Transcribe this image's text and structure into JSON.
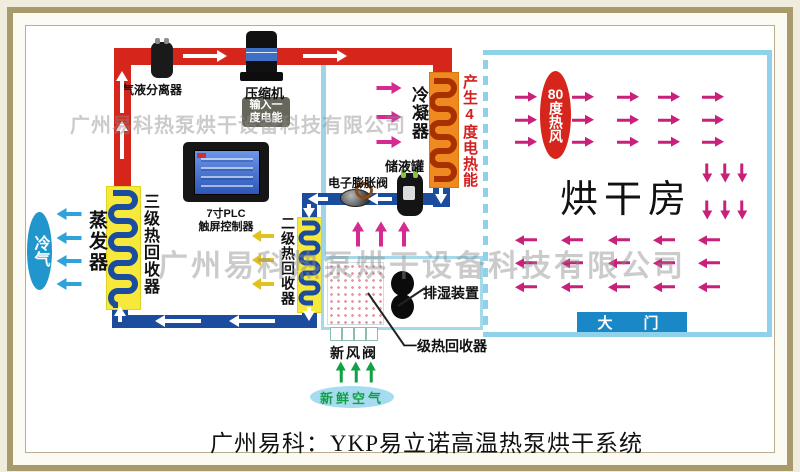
{
  "page": {
    "title_caption": "广州易科：YKP易立诺高温热泵烘干系统"
  },
  "watermarks": {
    "top": "广州易科热泵烘干设备科技有限公司",
    "middle": "广州易科热泵烘干设备科技有限公司"
  },
  "labels": {
    "gas_liquid_separator": "气液分离器",
    "compressor": "压缩机",
    "power_badge_line1": "输入一",
    "power_badge_line2": "度电能",
    "plc_line1": "7寸PLC",
    "plc_line2": "触屏控制器",
    "condenser": "冷凝器",
    "heat_gain_note": "产生4度电热能",
    "liquid_tank": "储液罐",
    "expansion_valve": "电子膨胀阀",
    "evaporator": "蒸发器",
    "stage3_recovery": "三级热回收器",
    "stage2_recovery": "二级热回收器",
    "stage1_recovery": "一级热回收器",
    "dehumidifier": "排湿装置",
    "fresh_air_valve": "新风阀"
  },
  "badges": {
    "cold_air": "冷气",
    "hot_air_line1": "80",
    "hot_air_line2": "度热风",
    "fresh_air": "新鲜空气",
    "door": "大　门",
    "drying_room": "烘干房"
  },
  "icons": {
    "flow_arrow": "triangle-arrow"
  },
  "colors": {
    "hot_pipe": "#d6261c",
    "cold_pipe": "#1b4c9e",
    "coil_bg": "#f6e93c",
    "coil_stroke": "#1b4c9e",
    "condenser_bg": "#ee8a1f",
    "condenser_stroke": "#a93000",
    "room_border": "#8fd0ea",
    "arrow_magenta": "#c92079",
    "arrow_pink": "#d62a93",
    "arrow_blue": "#2fa3d9",
    "arrow_yellow": "#dfc11f",
    "arrow_green": "#12a045",
    "badge_red": "#d6261c",
    "badge_blue": "#2196cc",
    "door_blue": "#1a87c6",
    "fresh_air_bg": "#a7dbef",
    "heat_note_red": "#d41f1f"
  }
}
